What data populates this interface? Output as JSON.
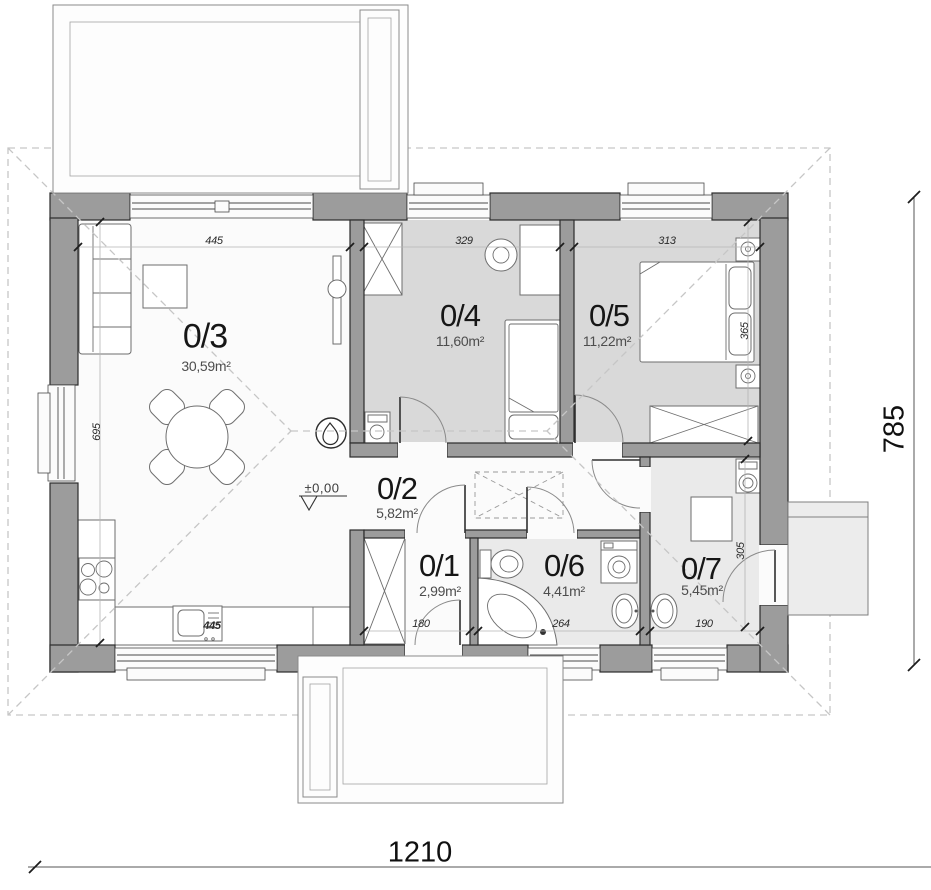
{
  "rooms": [
    {
      "number": "0/3",
      "area": "30,59m²"
    },
    {
      "number": "0/4",
      "area": "11,60m²"
    },
    {
      "number": "0/5",
      "area": "11,22m²"
    },
    {
      "number": "0/2",
      "area": "5,82m²"
    },
    {
      "number": "0/1",
      "area": "2,99m²"
    },
    {
      "number": "0/6",
      "area": "4,41m²"
    },
    {
      "number": "0/7",
      "area": "5,45m²"
    }
  ],
  "dimensions": {
    "overall_width": "1210",
    "overall_height": "785",
    "living_width": "445",
    "living_height": "695",
    "room04_width": "329",
    "room05_width": "313",
    "room05_height": "365",
    "room01_width": "180",
    "room06_width": "264",
    "room07_width": "190",
    "room07_height": "305",
    "kitchen_counter": "445"
  },
  "level_marker": "±0,00",
  "colors": {
    "wall": "#9c9c9c",
    "bedroom_floor": "#d9d9d9",
    "service_floor": "#eaeaea",
    "base_floor": "#fbfbfb",
    "roof_dash": "#c6c6c6",
    "furniture_line": "#6e6e6e",
    "terrace_line": "#8a8a8a"
  }
}
